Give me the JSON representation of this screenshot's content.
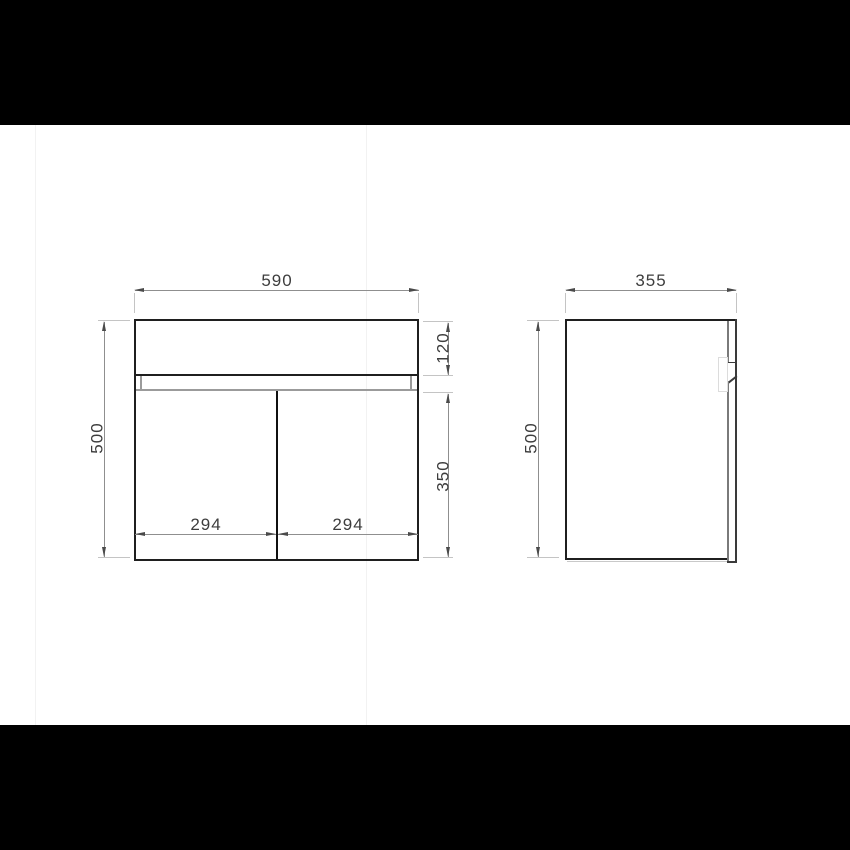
{
  "front_view": {
    "overall_width": "590",
    "overall_height": "500",
    "top_panel_height": "120",
    "door_height": "350",
    "door_width_left": "294",
    "door_width_right": "294"
  },
  "side_view": {
    "depth": "355",
    "height": "500"
  },
  "colors": {
    "background": "#ffffff",
    "letterbox": "#000000",
    "outline": "#1f1f1f",
    "secondary_line": "#9b9b9b",
    "door_edge_line": "#7a7a7a",
    "recess_outline": "#dcdcdc",
    "dimension_line": "#8f8f8f",
    "extension_line": "#c4c4c4",
    "arrowhead": "#4a4a4a",
    "dimension_text": "#3d3d3d"
  }
}
